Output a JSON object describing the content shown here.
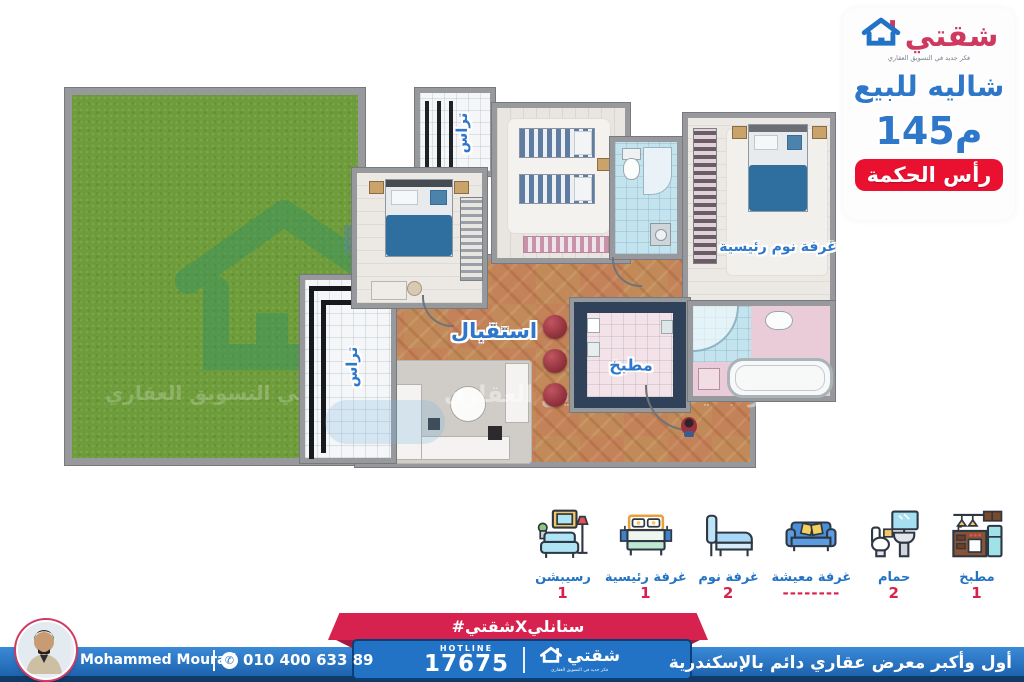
{
  "brand": {
    "name": "شقتي",
    "tagline": "فكر جديد في التسويق العقاري"
  },
  "offer": {
    "title": "شاليه للبيع",
    "area": "145م",
    "location": "رأس الحكمة"
  },
  "plan": {
    "labels": {
      "terrace_top": "تراس",
      "terrace_left": "تراس",
      "reception": "استقبال",
      "kitchen": "مطبخ",
      "master_bedroom": "غرفة نوم رئيسية"
    },
    "watermark": "فكر جديد في التسويق العقاري"
  },
  "legend": {
    "items": [
      {
        "name": "reception",
        "label": "رسيبشن",
        "count": "1"
      },
      {
        "name": "master-bedroom",
        "label": "غرفة رئيسية",
        "count": "1"
      },
      {
        "name": "bedroom",
        "label": "غرفة نوم",
        "count": "2"
      },
      {
        "name": "living-room",
        "label": "غرفة معيشة",
        "count": "--------"
      },
      {
        "name": "bathroom",
        "label": "حمام",
        "count": "2"
      },
      {
        "name": "kitchen",
        "label": "مطبخ",
        "count": "1"
      }
    ]
  },
  "footer": {
    "agent_name": "Mohammed Mourad",
    "phone": "010 400 633 89",
    "hashtag": "#شقتيXستانلي",
    "hotline_label": "HOTLINE",
    "hotline_number": "17675",
    "brand_name": "شقتي",
    "logo_caption": "فكر جديد في التسويق العقاري",
    "exhibition_tagline": "أول وأكبر معرض عقاري دائم بالإسكندرية"
  },
  "icons": {
    "phone": "✆"
  },
  "colors": {
    "primary_blue": "#2f78c9",
    "brand_crimson": "#d0395f",
    "badge_red": "#ea1130",
    "ribbon_crimson": "#d7214e",
    "footer_blue": "#2273c5",
    "footer_navy": "#123a66",
    "legend_count_red": "#d7214e",
    "garden_green": "#6e9c3a"
  }
}
